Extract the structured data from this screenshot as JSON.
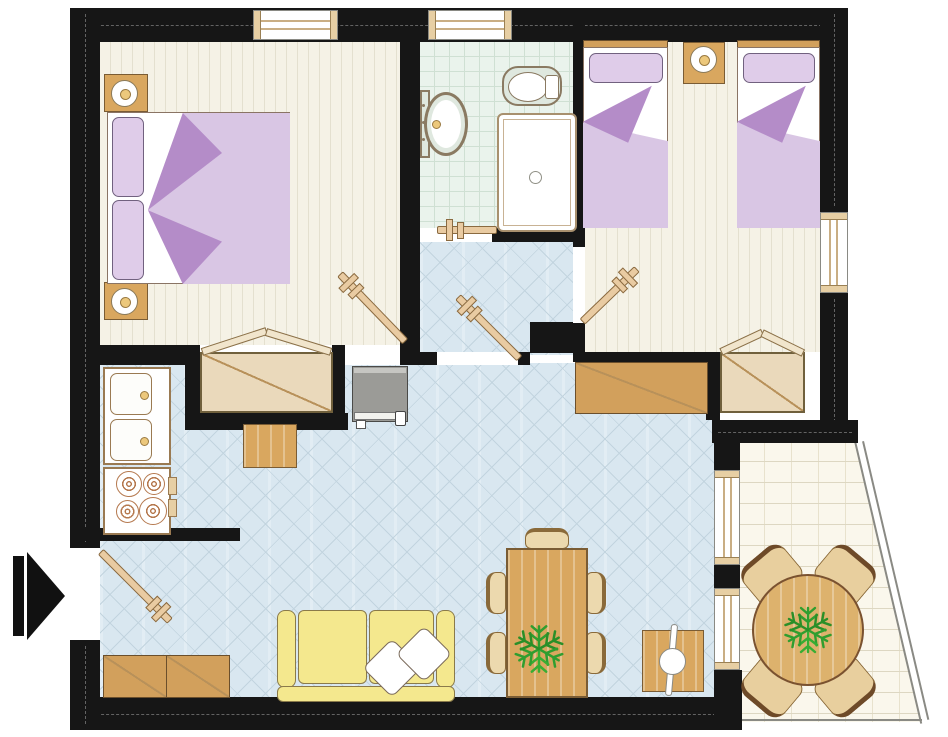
{
  "meta": {
    "type": "architectural-floor-plan",
    "description": "Top-down floor plan of a two-bedroom apartment with bathroom, hallway, kitchen / living-dining room and a trapezoidal terrace; entrance marked by a black arrow on the left",
    "visible_text": "none"
  },
  "palette": {
    "wall": "#161616",
    "bedroom_floor": "#f5f2e6",
    "bedroom_stripe": "#e4e0cf",
    "bathroom_floor": "#eaf3ec",
    "bathroom_grid": "#cfe0d3",
    "hall_floor": "#d9e7f0",
    "hall_line": "#c2d4df",
    "terrace_floor": "#faf7ec",
    "terrace_line": "#ddd7c2",
    "wood": "#d9a75f",
    "wardrobe": "#ead9bb",
    "door_leaf": "#e9cba2",
    "blanket": "#d9c6e4",
    "blanket_fold": "#b48cc8",
    "pillow": "#dfcce9",
    "sofa": "#f4e88e",
    "fixture": "#dfe8df",
    "fixture_border": "#8a7a62",
    "appliance_gray": "#9b9b97",
    "plant_green": "#2f9e2f"
  },
  "rooms": [
    {
      "name": "bedroom-1",
      "position": "top-left",
      "floor": "striped parquet",
      "furniture": [
        "double bed with lilac duvet",
        "2 pillows",
        "2 nightstands with lamps",
        "built-in wardrobe with open doors",
        "window on top wall",
        "door to kitchen area"
      ]
    },
    {
      "name": "bathroom",
      "position": "top-center",
      "floor": "mint tile grid",
      "furniture": [
        "washbasin",
        "toilet",
        "square shower tray",
        "window on top wall",
        "door to hallway"
      ]
    },
    {
      "name": "bedroom-2",
      "position": "top-right",
      "floor": "striped parquet",
      "furniture": [
        "2 single beds with lilac duvets",
        "shared nightstand with lamp",
        "built-in wardrobe with open doors",
        "window on right wall",
        "door to hallway"
      ]
    },
    {
      "name": "hallway",
      "position": "center",
      "floor": "blue diamond tile",
      "furniture": [
        "door to bathroom",
        "door to bedroom-2",
        "door to living room"
      ]
    },
    {
      "name": "kitchen-living-room",
      "position": "bottom",
      "floor": "blue diamond tile",
      "furniture": [
        "double sink unit",
        "4-burner stove",
        "refrigerator",
        "small square table",
        "sideboard",
        "entry cabinet",
        "yellow sofa with 2 white cushions",
        "dining table with plant and 5 chairs",
        "side table with lamp",
        "entrance door"
      ]
    },
    {
      "name": "terrace",
      "position": "bottom-right",
      "floor": "brick paving",
      "furniture": [
        "round table with plant",
        "4 chairs"
      ]
    }
  ],
  "counts": {
    "windows": 5,
    "door_leaves": 5,
    "wardrobes": 2,
    "beds": 3,
    "plants": 2
  },
  "entrance": {
    "marker": "black arrow",
    "side": "left",
    "direction": "pointing right into apartment"
  }
}
